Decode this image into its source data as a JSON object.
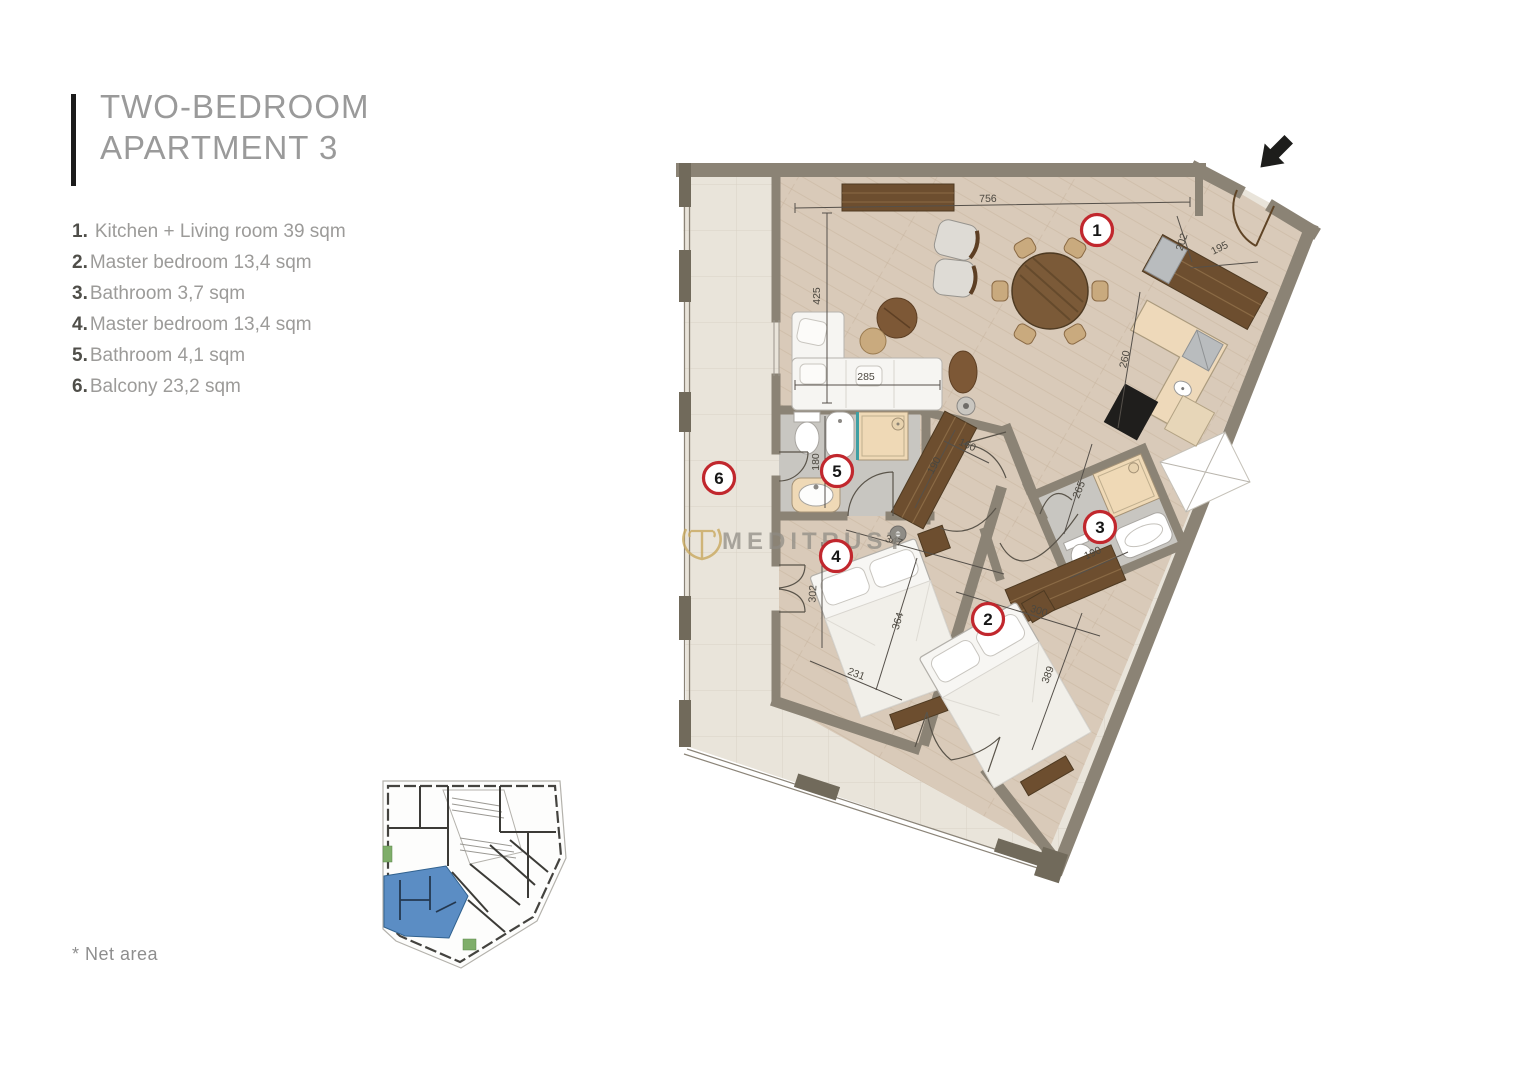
{
  "page": {
    "title_line1": "TWO-BEDROOM",
    "title_line2": "APARTMENT 3",
    "footnote": "* Net area"
  },
  "legend": {
    "items": [
      {
        "num": "1.",
        "label": "Kitchen + Living room 39 sqm"
      },
      {
        "num": "2.",
        "label": "Master bedroom 13,4 sqm"
      },
      {
        "num": "3.",
        "label": "Bathroom 3,7 sqm"
      },
      {
        "num": "4.",
        "label": "Master bedroom 13,4 sqm"
      },
      {
        "num": "5.",
        "label": "Bathroom 4,1 sqm"
      },
      {
        "num": "6.",
        "label": "Balcony 23,2 sqm"
      }
    ]
  },
  "plan": {
    "watermark": "MEDITRUST",
    "badges": [
      "1",
      "2",
      "3",
      "4",
      "5",
      "6"
    ],
    "dims": [
      "756",
      "425",
      "285",
      "202",
      "195",
      "260",
      "180",
      "190",
      "160",
      "265",
      "190",
      "347",
      "302",
      "364",
      "231",
      "300",
      "389"
    ],
    "colors": {
      "wall": "#8b8375",
      "wall_block": "#716a5b",
      "wood_floor": "#d9cab9",
      "balcony_tile": "#e9e4da",
      "bath_floor": "#c8c6c1",
      "fixture_beige": "#efd9b6",
      "dark_wood": "#6d4e2f",
      "badge_red": "#c1272d",
      "watermark_gold": "#c9a95f",
      "minimap_highlight": "#5b8dc4"
    }
  }
}
